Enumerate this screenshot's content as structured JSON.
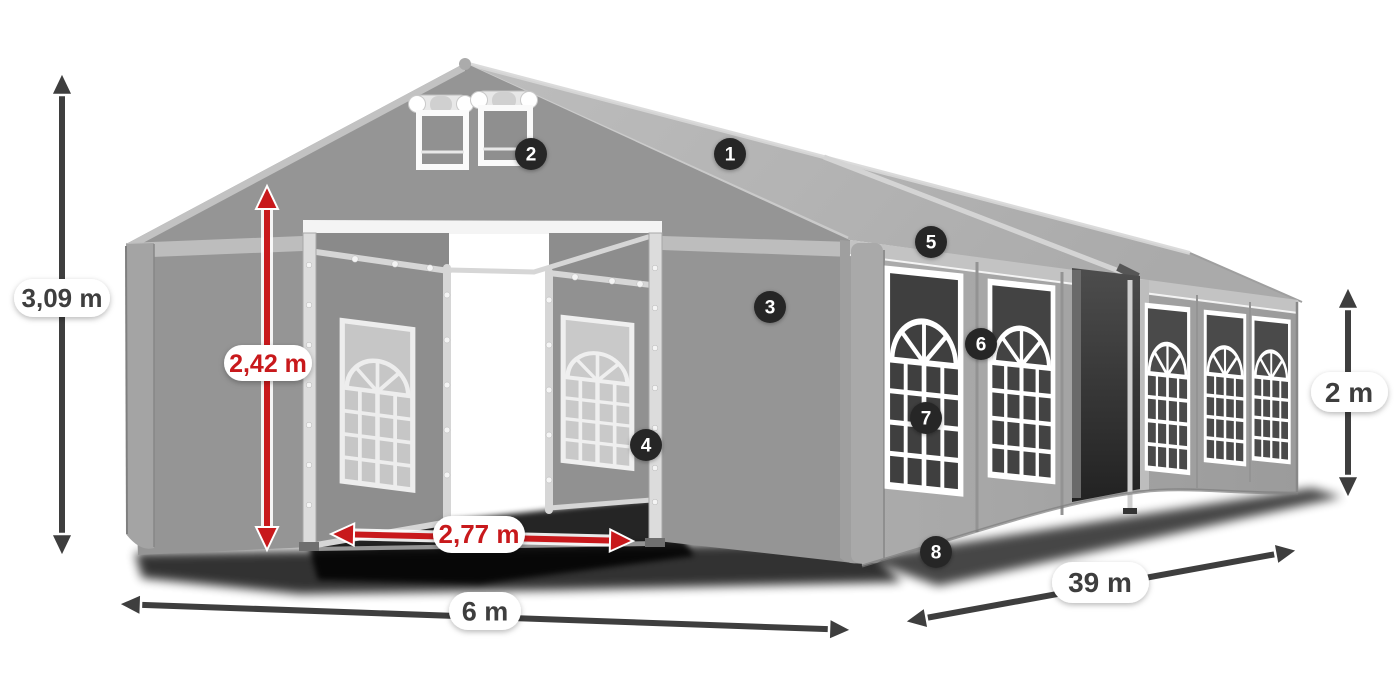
{
  "diagram": {
    "subject": "Marquee tent dimension diagram with numbered feature hotspots",
    "dimensions": [
      {
        "id": "total-height",
        "label": "3,09 m",
        "style": "dark"
      },
      {
        "id": "entrance-height",
        "label": "2,42 m",
        "style": "red"
      },
      {
        "id": "entrance-width",
        "label": "2,77 m",
        "style": "red"
      },
      {
        "id": "front-width",
        "label": "6 m",
        "style": "dark"
      },
      {
        "id": "side-length",
        "label": "39 m",
        "style": "dark"
      },
      {
        "id": "side-wall-height",
        "label": "2 m",
        "style": "dark"
      }
    ],
    "hotspots": [
      {
        "number": "1"
      },
      {
        "number": "2"
      },
      {
        "number": "3"
      },
      {
        "number": "4"
      },
      {
        "number": "5"
      },
      {
        "number": "6"
      },
      {
        "number": "7"
      },
      {
        "number": "8"
      }
    ],
    "colors": {
      "accent_red": "#c8191c",
      "dim_dark": "#3e3e3e",
      "badge_bg": "#282828",
      "badge_text": "#ffffff",
      "pill_bg": "#ffffff",
      "tent_roof": "#b6b6b6",
      "tent_front": "#959595",
      "tent_side": "#a6a6a6",
      "window_dark": "#414141",
      "frame_white": "#ffffff",
      "background": "#ffffff"
    }
  }
}
